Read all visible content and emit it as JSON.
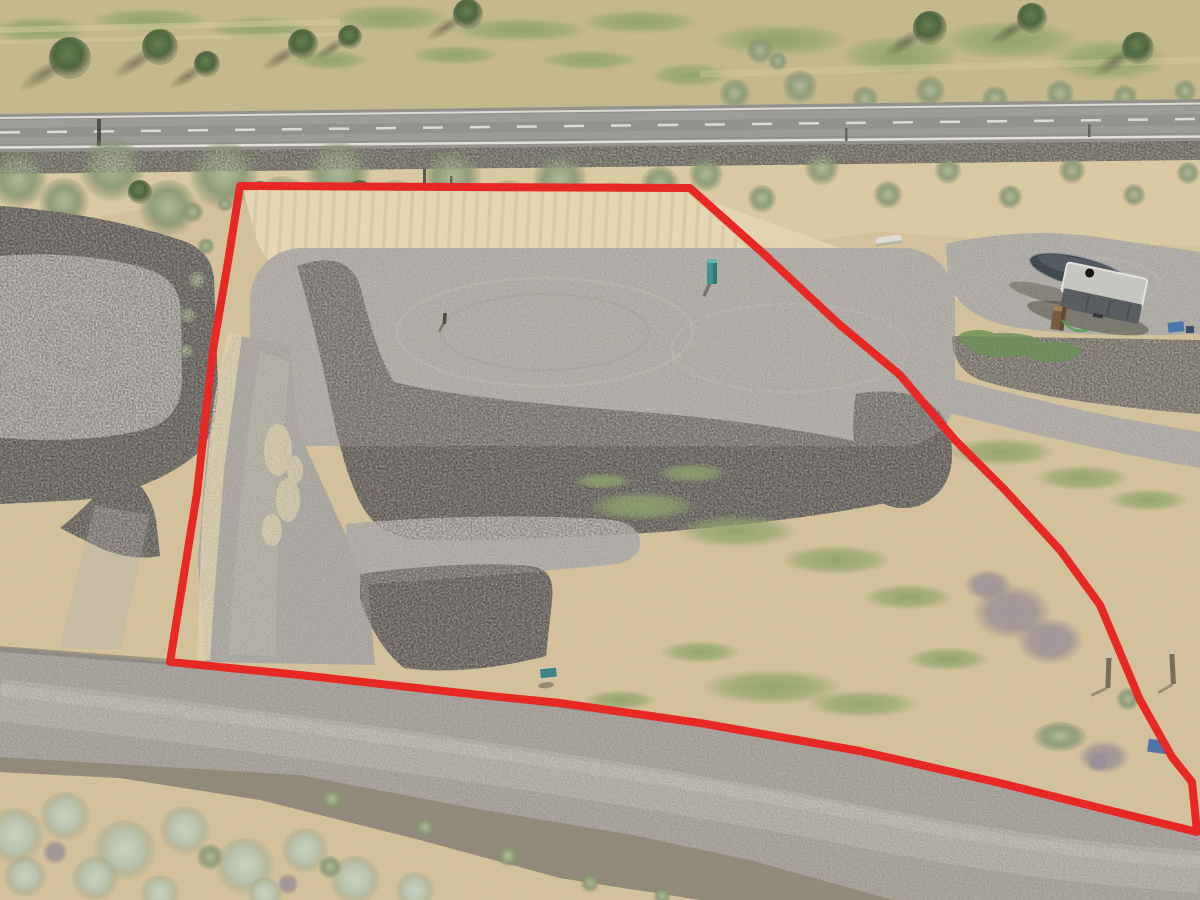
{
  "meta": {
    "description": "Aerial drone photograph of a graded vacant land parcel outlined with a red property boundary, bordered by a paved highway above and a gravel road below, with neighboring gravel pads on both sides and a covered boat and cargo trailer parked on the east pad.",
    "visible_text": "none"
  },
  "boundary": {
    "color": "#ee1512",
    "stroke_width": 8,
    "points": "240,186 690,188 765,255 840,325 900,375 955,440 1005,490 1060,550 1100,605 1140,700 1172,757 1192,782 1197,832 1100,808 1000,783 860,751 700,723 560,703 480,695 300,675 170,662 197,493 213,350 228,262"
  },
  "palette": {
    "sand": "#d6c399",
    "sand_light": "#e3d2a6",
    "sand_pale": "#eadcb4",
    "grass_dry": "#c6b987",
    "grass_green": "#96a46e",
    "sage": "#8a9a73",
    "sage_silver": "#b9c4ae",
    "pine": "#3f5c31",
    "dead_brush": "#8f8490",
    "asphalt": "#8e8d89",
    "asphalt_edge": "#6c6a60",
    "line_white": "#eceae4",
    "pad": "#a9a59e",
    "pad_light": "#bab6af",
    "driveway": "#a29e97",
    "riprap": "#5b5753",
    "riprap_light": "#7d786f",
    "road_gravel": "#a19b93",
    "road_light": "#c3bbb0",
    "road_dark": "#66625a",
    "road_shoulder": "#8a8273",
    "teal": "#2e8e87",
    "sign_teal": "#2f7d80",
    "boat_cover": "#333a42",
    "trailer_side": "#4d5257",
    "trailer_top": "#c8c8c4",
    "blue_item": "#3e6da8",
    "brown_box": "#6f4f33",
    "post_brown": "#6e6353",
    "white_object": "#e3e1da",
    "shadow": "#3a3a2c"
  },
  "objects": {
    "scene": "aerial view of vacant land parcel for sale",
    "boundary": "red property boundary outline",
    "highway": "paved two-lane highway with fog lines and dashed centerline",
    "gravel_road": "gravel access road",
    "parcel_pad": "graded gravel building pad",
    "riprap": "dark rock riprap berm",
    "cut_bank": "graded sandy cut bank",
    "left_pad": "neighboring gravel pad (west)",
    "right_pad": "neighboring gravel pad with vehicles (east)",
    "driveway": "gravel driveway",
    "boat": "boat under dark cover",
    "trailer": "enclosed cargo trailer",
    "utility_post": "green utility marker post",
    "lot_sign": "small green lot sign",
    "survey_stake": "survey stake",
    "fence_posts": "wooden fence posts",
    "white_object": "small white object at base of cut bank",
    "brown_box": "brown box near trailer",
    "blue_items": "blue gear near boundary",
    "trees": "pine trees along highway",
    "sagebrush": "sagebrush and dry grass",
    "grass_patches": "green grass patches",
    "dead_brush": "dried gray sagebrush"
  }
}
